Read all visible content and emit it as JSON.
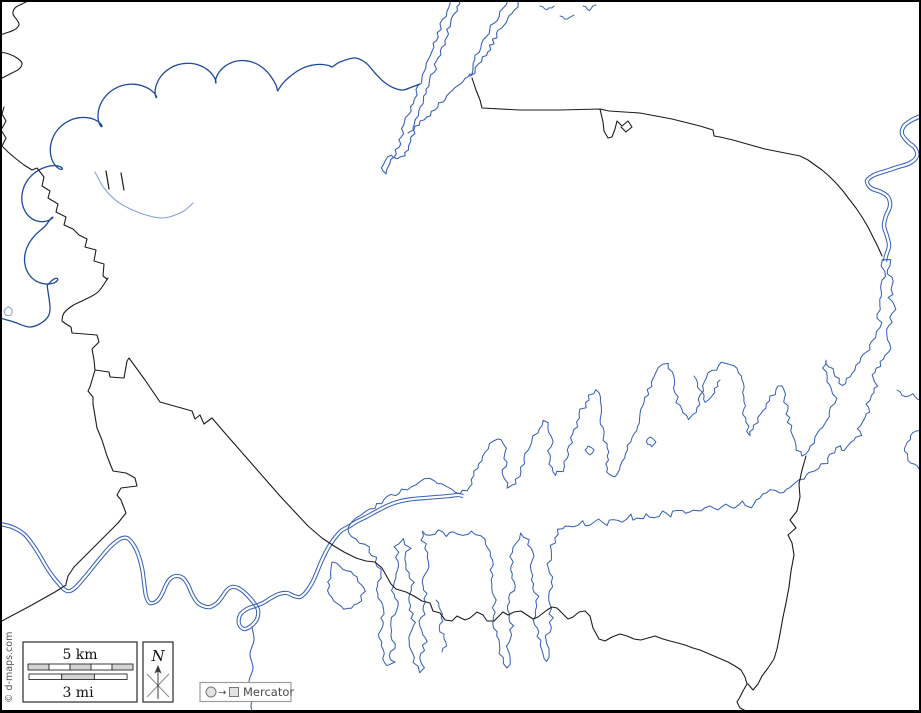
{
  "map": {
    "attribution": "© d-maps.com"
  },
  "scale_bar": {
    "km_label": "5 km",
    "mi_label": "3 mi"
  },
  "compass": {
    "north_label": "N"
  },
  "projection": {
    "arrow": "→",
    "label": "Mercator"
  },
  "colors": {
    "frame": "#000000",
    "boundary": "#1c1c1c",
    "river": "#1f4a9c",
    "water": "#3a63b8",
    "water_light": "#8aa3d6",
    "bar_fill": "#d4d4d4",
    "bar_stroke": "#2a2a2a",
    "legend_text": "#4a4a4a",
    "legend_border": "#9c9c9c",
    "legend_fill": "#e2e2e2",
    "attribution_text": "#555555"
  }
}
